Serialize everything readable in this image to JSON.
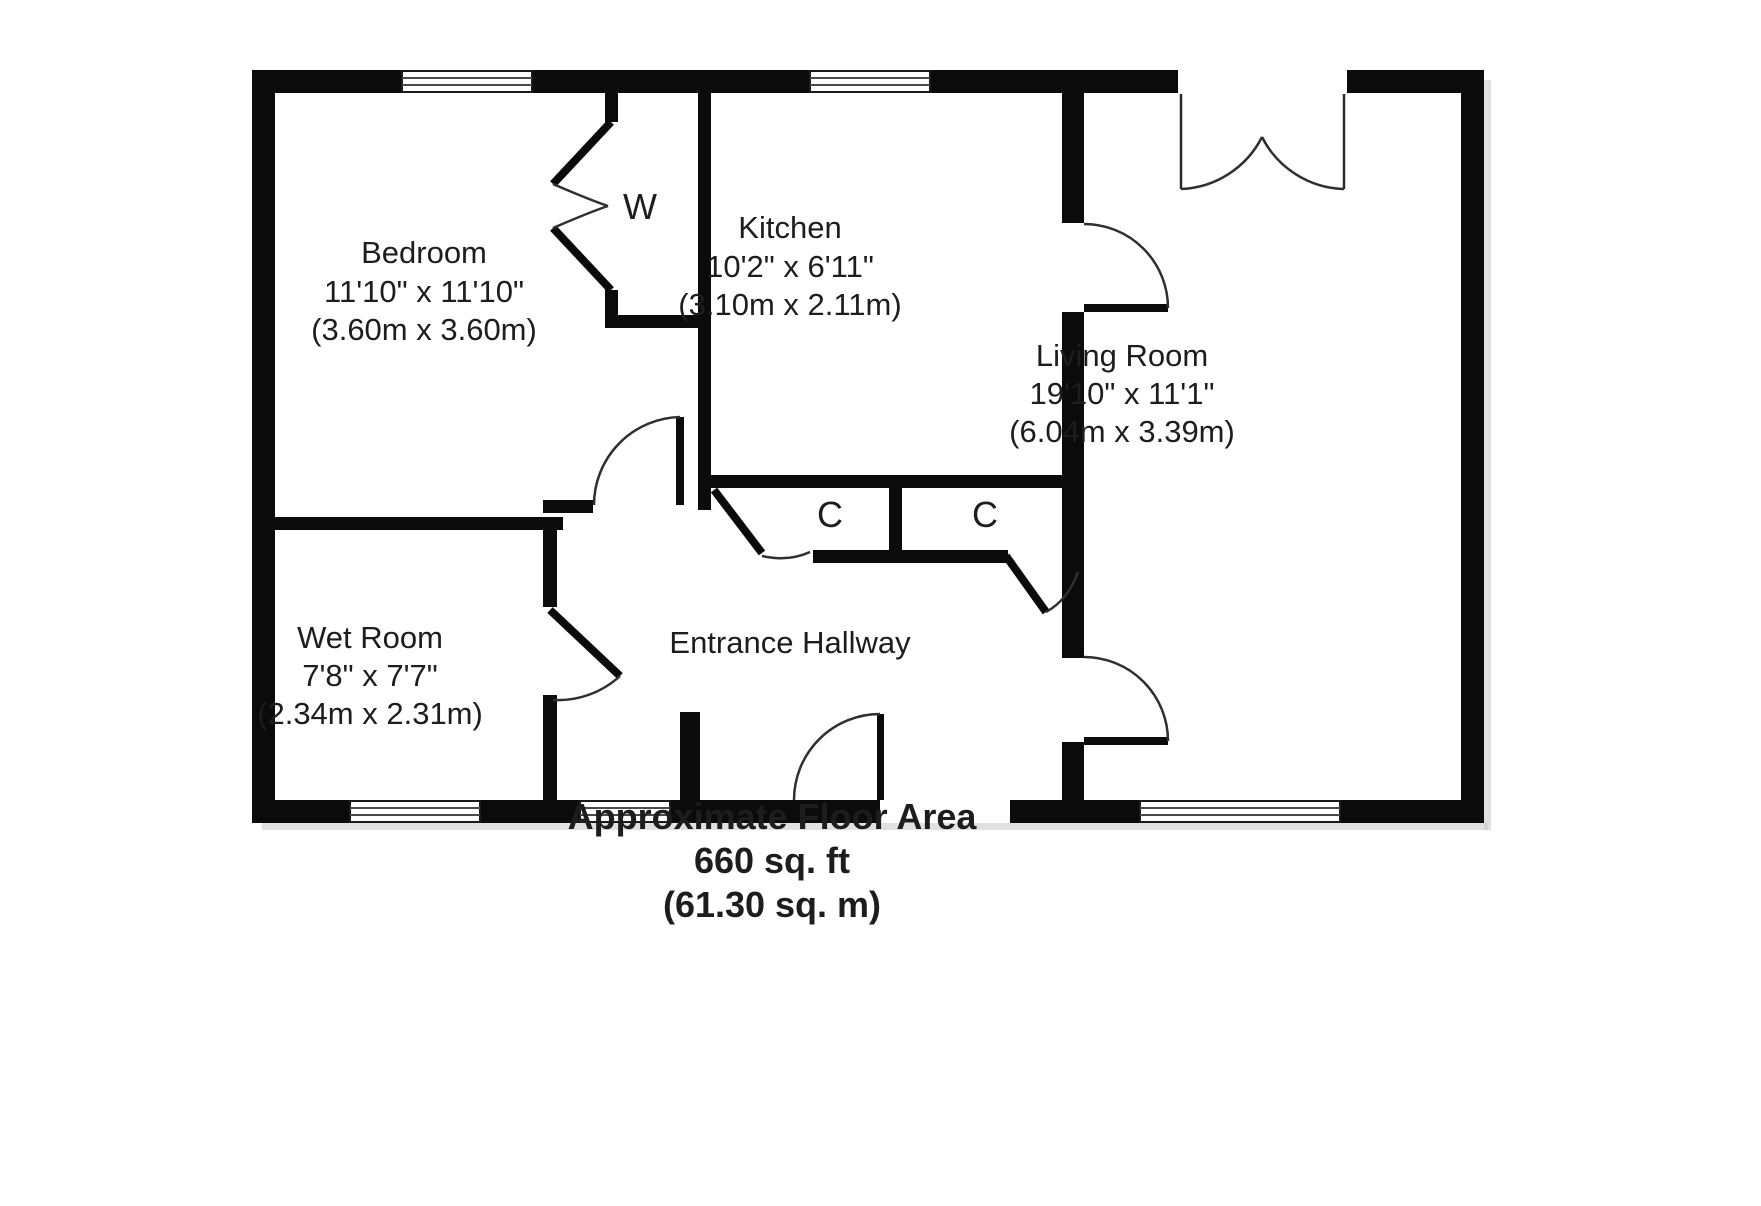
{
  "colors": {
    "background": "#ffffff",
    "wall": "#0b0b0b",
    "text": "#1d1d1d"
  },
  "rooms": [
    {
      "name": "Bedroom",
      "imperial": "11'10\" x 11'10\"",
      "metric": "(3.60m x 3.60m)"
    },
    {
      "name": "Kitchen",
      "imperial": "10'2\" x 6'11\"",
      "metric": "(3.10m x 2.11m)"
    },
    {
      "name": "Living Room",
      "imperial": "19'10\" x 11'1\"",
      "metric": "(6.04m x 3.39m)"
    },
    {
      "name": "Wet Room",
      "imperial": "7'8\" x 7'7\"",
      "metric": "(2.34m x 2.31m)"
    },
    {
      "name": "Entrance Hallway",
      "imperial": "",
      "metric": ""
    }
  ],
  "closets": [
    {
      "label": "W"
    },
    {
      "label": "C"
    },
    {
      "label": "C"
    }
  ],
  "footer": {
    "line1": "Approximate Floor Area",
    "line2": "660 sq. ft",
    "line3": "(61.30 sq. m)"
  }
}
